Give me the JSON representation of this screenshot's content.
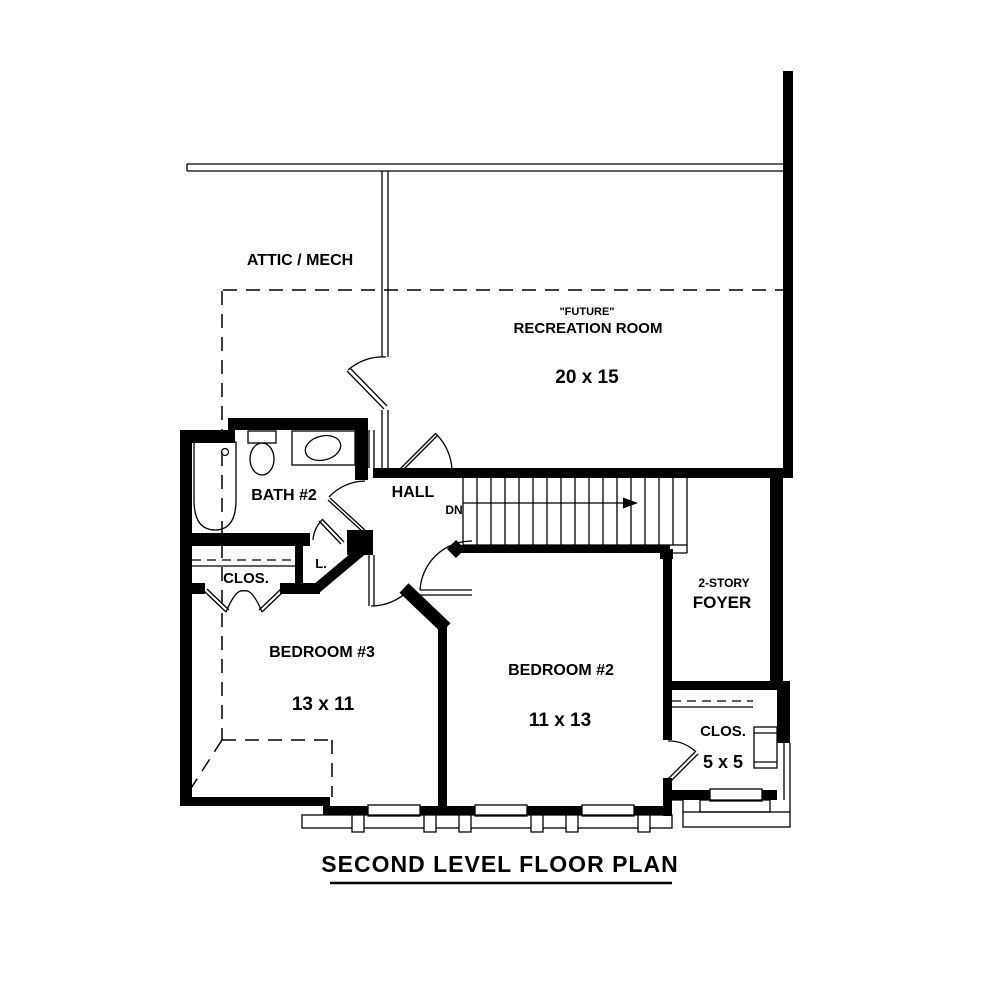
{
  "title": {
    "text": "SECOND LEVEL FLOOR PLAN"
  },
  "rooms": [
    {
      "id": "attic",
      "label": "ATTIC / MECH"
    },
    {
      "id": "recreation",
      "label_prefix": "\"FUTURE\"",
      "label": "RECREATION ROOM",
      "dimensions": "20 x 15"
    },
    {
      "id": "bath2",
      "label": "BATH #2"
    },
    {
      "id": "hall",
      "label": "HALL"
    },
    {
      "id": "stairs",
      "label": "DN"
    },
    {
      "id": "linen",
      "label": "L."
    },
    {
      "id": "closet3",
      "label": "CLOS."
    },
    {
      "id": "bedroom3",
      "label": "BEDROOM #3",
      "dimensions": "13 x 11"
    },
    {
      "id": "bedroom2",
      "label": "BEDROOM #2",
      "dimensions": "11 x 13"
    },
    {
      "id": "foyer",
      "label_prefix": "2-STORY",
      "label": "FOYER"
    },
    {
      "id": "closet2",
      "label": "CLOS.",
      "dimensions": "5 x 5"
    }
  ],
  "colors": {
    "wall": "#000000",
    "background": "#ffffff"
  }
}
